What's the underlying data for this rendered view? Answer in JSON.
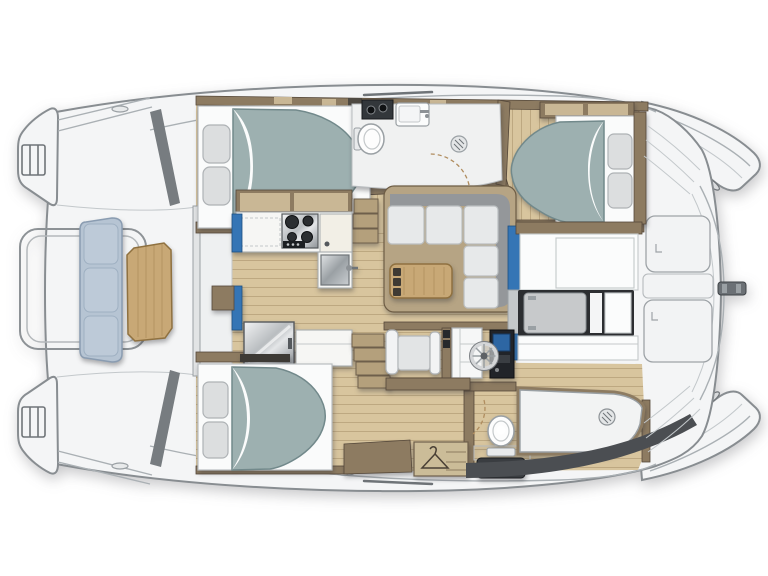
{
  "document": {
    "title": "Catamaran interior deck plan",
    "type": "vessel floor plan",
    "view": "top-down",
    "orientation": "bow-left",
    "background": "#ffffff"
  },
  "palette": {
    "deck": "#f4f5f6",
    "deckStroke": "#888d91",
    "floorWood": "#d8c59e",
    "floorWoodLine": "#bba87e",
    "wall": "#8d7b61",
    "wallDark": "#55483a",
    "bedBase": "#fafbfb",
    "pillow": "#dcdedf",
    "duvet": "#9db0b0",
    "duvetStroke": "#72898b",
    "benchCushion": "#b6c4d3",
    "benchStroke": "#8a9cb1",
    "tableWood": "#c8a876",
    "tableStroke": "#8f7140",
    "sofaCushion": "#e7e9ea",
    "sofaBack": "#94979a",
    "accentBlue": "#3575b5",
    "screenBlue": "#2d66a3",
    "applianceDark": "#2c3034",
    "bathFloor": "#f0f1f1",
    "fixtureStroke": "#9aa0a4",
    "stepWood": "#b4a07c",
    "darkBand": "#4b4e52",
    "consoleDark": "#212429",
    "grayPanel": "#c7c9cb",
    "doorArc": "#b08d5f"
  },
  "vessel": {
    "areas": [
      {
        "id": "forward-cockpit",
        "features": [
          "bench-seat",
          "cockpit-table",
          "guard-rail",
          "bow-ladder-port",
          "bow-ladder-starboard",
          "crossbeam"
        ]
      },
      {
        "id": "salon",
        "features": [
          "galley-cabinet",
          "galley-counter",
          "stove",
          "sink",
          "refrigerator",
          "l-sofa",
          "coffee-table",
          "companionway-steps",
          "forward-console"
        ]
      },
      {
        "id": "starboard-hull-forward-cabin",
        "features": [
          "double-berth",
          "pillows"
        ]
      },
      {
        "id": "starboard-hull-bathroom",
        "features": [
          "toilet",
          "washbasin",
          "cooktop-unit",
          "shower-drain",
          "door-swing"
        ]
      },
      {
        "id": "starboard-hull-aft-cabin",
        "features": [
          "double-berth",
          "pillows",
          "overhead-lockers",
          "hanging-locker"
        ]
      },
      {
        "id": "port-hull-forward-cabin",
        "features": [
          "double-berth",
          "pillows"
        ]
      },
      {
        "id": "port-hull-dressing-area",
        "features": [
          "seat",
          "vanity-dresser",
          "helm-wheel",
          "instrument-console",
          "wardrobe-with-hanger"
        ]
      },
      {
        "id": "port-hull-bathroom",
        "features": [
          "toilet",
          "shower-tray",
          "shower-drain",
          "dark-utility-unit"
        ]
      },
      {
        "id": "aft-cockpit",
        "features": [
          "bench-panels",
          "engine-hatch-panel"
        ]
      },
      {
        "id": "stern-platform",
        "features": [
          "locker-hatch-top",
          "locker-hatch-bottom",
          "center-panel",
          "cleat-fitting"
        ]
      },
      {
        "id": "transoms",
        "features": [
          "boarding-steps",
          "scupper-top",
          "scupper-bottom"
        ]
      }
    ]
  }
}
